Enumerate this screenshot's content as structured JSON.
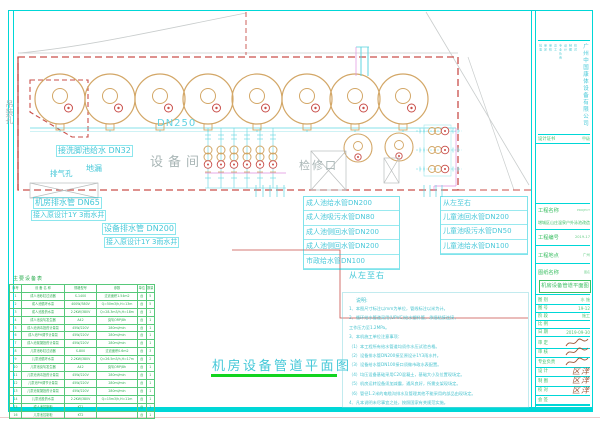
{
  "plan": {
    "title": "机房设备管道平面图",
    "room_label": "设备间",
    "dn250": "DN250",
    "footbath": "接洗脚池给水 DN32",
    "lifting_hole": "吊装孔",
    "vent_hole": "排气孔",
    "floor_drain": "地漏",
    "access_label": "检修口",
    "drain1a": "机房排水管 DN65",
    "drain1b": "接入原设计1Y 3雨水井",
    "drain2a": "设备排水管 DN200",
    "drain2b": "接入原设计1Y 3雨水井",
    "dir_note_mid": "从左至右",
    "child_header": "从左至右",
    "adult_list": [
      "成人池给水管DN200",
      "成人池吸污水管DN80",
      "成人池侧回水管DN200",
      "成人池侧回水管DN200",
      "市政给水管DN100"
    ],
    "child_list": [
      "儿童池回水管DN200",
      "儿童池吸污水管DN50",
      "儿童池给水管DN100"
    ]
  },
  "notes": {
    "title": "说明:",
    "lines": [
      "1、本图尺寸标注以mm为单位，管线标注以米为计。",
      "2、循环给水管道采用(UPVC)给水塑料管，承插粘接连接，",
      "      工作压力至1.2MPa。",
      "3、本机施工单位注意事项：",
      "   （1）本工程所有给水管道均须作水压试验合格。",
      "   （2）设备排水管DN200接至原设计1Y3雨水井。",
      "   （3）设备给水管DN100接口须做市政水表配置。",
      "   （4）均压设备基础采用C20混凝土，基础大小及位置现场定。",
      "   （5）机房运转设备须加减震，通风良好，所需支架现场定。",
      "   （6）管径1.2米的电缆沟排水及管理其他不能采用的部品由现场定。",
      "4、凡本说明未尽事宜之处，按照国家有关规范实施。"
    ]
  },
  "equipment_table": {
    "title": "主要设备表",
    "headers": [
      "序号",
      "设 备 名 称",
      "规格型号",
      "参数",
      "单位",
      "数量"
    ],
    "rows": [
      [
        "1",
        "成人池砂缸过滤器",
        "S-1400",
        "过滤面积1.54m2",
        "台",
        "5"
      ],
      [
        "2",
        "成人池循环水泵",
        "400W/380V",
        "Q=50m3/h,H=13m",
        "台",
        "5"
      ],
      [
        "3",
        "成人池投药水泵",
        "2.2KW/380V",
        "Q=28.3m3/h,H=18m",
        "台",
        "1"
      ],
      [
        "4",
        "成人池臭氧发生器",
        "A42",
        "臭氧ORP/8h",
        "台",
        "1"
      ],
      [
        "5",
        "成人池消毒投药计量泵",
        "45W/220V",
        "280ml/min",
        "台",
        "1"
      ],
      [
        "6",
        "成人池PH调节计量泵",
        "45W/220V",
        "280ml/min",
        "台",
        "1"
      ],
      [
        "7",
        "成人池絮凝投药计量泵",
        "45W/220V",
        "280ml/min",
        "台",
        "1"
      ],
      [
        "8",
        "儿童池砂缸过滤器",
        "S-800",
        "过滤面积0.6m2",
        "台",
        "3"
      ],
      [
        "9",
        "儿童池循环水泵",
        "2.2KW/380V",
        "Q=26.5m3/h,H=17m",
        "台",
        "2"
      ],
      [
        "10",
        "儿童池臭氧发生器",
        "A42",
        "臭氧ORP/8h",
        "台",
        "1"
      ],
      [
        "11",
        "儿童池消毒投药计量泵",
        "45W/220V",
        "280ml/min",
        "台",
        "1"
      ],
      [
        "12",
        "儿童池PH调节计量泵",
        "45W/220V",
        "280ml/min",
        "台",
        "1"
      ],
      [
        "13",
        "儿童池絮凝投药计量泵",
        "45W/220V",
        "280ml/min",
        "台",
        "1"
      ],
      [
        "14",
        "儿童池投药水泵",
        "2.2KW/380V",
        "Q=15m3/h,H=11m",
        "台",
        "1"
      ],
      [
        "15",
        "成人池控制柜",
        "KT1",
        "",
        "台",
        "1"
      ],
      [
        "16",
        "儿童池控制柜",
        "KT2",
        "",
        "台",
        "1"
      ]
    ]
  },
  "title_block": {
    "company": "广州中国康体设备有限公司",
    "approval_columns": [
      "批准",
      "审定",
      "审核",
      "总工",
      "专业负责",
      "设计",
      "制图",
      "校对"
    ],
    "cert_label": "设计证书",
    "cert_value": "甲级",
    "proj_name_label": "工程名称",
    "proj_name_tag": "PROJECT",
    "proj_name": "增城区山庄温泉户外泳池改造",
    "proj_no_label": "工程编号",
    "proj_no": "2019-17",
    "loc_label": "工程地点",
    "loc_value": "广州",
    "dwg_label": "图纸名称",
    "dwg_tag": "图名",
    "dwg_name": "机房设备管道平面图",
    "attrs": [
      {
        "label": "图 别",
        "value": "水 施"
      },
      {
        "label": "图 号",
        "value": "19-12"
      },
      {
        "label": "阶 段",
        "value": "施工"
      },
      {
        "label": "比 例",
        "value": ""
      },
      {
        "label": "日 期",
        "value": "2019-09-30"
      }
    ],
    "signatures": [
      {
        "label": "审 定",
        "sign": "script"
      },
      {
        "label": "审 核",
        "sign": "script"
      },
      {
        "label": "专业负责",
        "sign": "script"
      },
      {
        "label": "设 计",
        "sign": "区洋"
      },
      {
        "label": "制 图",
        "sign": "区洋"
      },
      {
        "label": "校 对",
        "sign": "区洋"
      },
      {
        "label": "会 签",
        "sign": ""
      }
    ],
    "colors": {
      "cyan": "#00d7d7",
      "red": "#c94f4a",
      "tan": "#d3a767",
      "green": "#3bbf63",
      "pink": "#df8fdf",
      "sign_brown": "#9b5638"
    }
  }
}
